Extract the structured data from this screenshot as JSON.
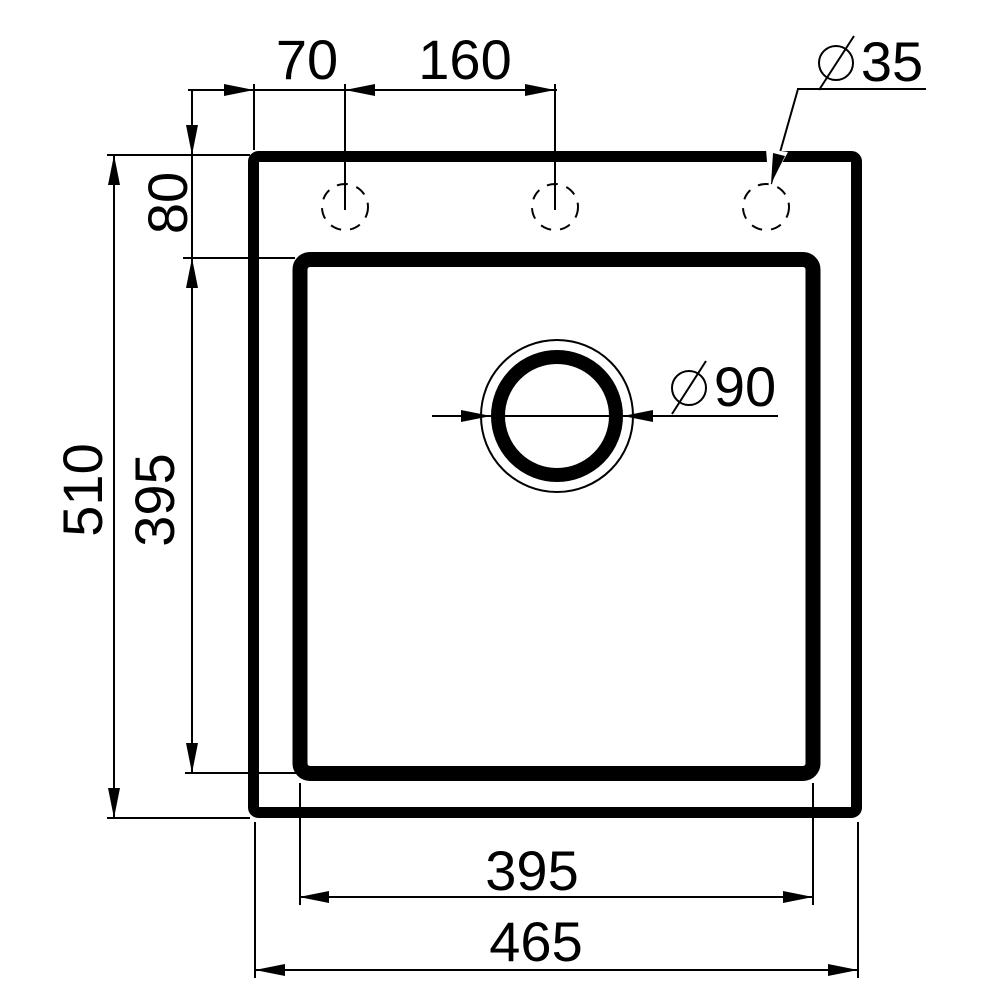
{
  "dims": {
    "hole_offset_left": "70",
    "hole_spacing": "160",
    "hole_diameter": "35",
    "rim_to_bowl": "80",
    "overall_height": "510",
    "bowl_height": "395",
    "drain_diameter": "90",
    "bowl_width": "395",
    "overall_width": "465"
  },
  "symbols": {
    "diameter": "⌀"
  },
  "colors": {
    "line": "#000000",
    "background": "#ffffff"
  }
}
